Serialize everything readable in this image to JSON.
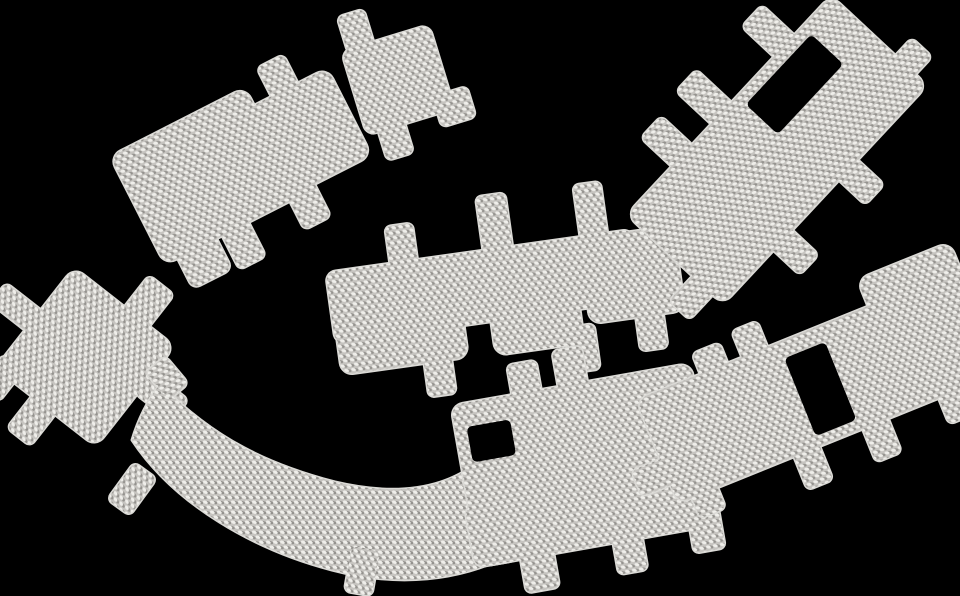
{
  "scene": {
    "description": "Product photograph of eight die-cut metallic heat-shield insulation pieces with a woven basketweave aluminum texture, scattered loosely on a black background. Each piece is an irregular panel with short rounded mounting tabs on its edges; two pieces have rectangular slot cutouts.",
    "canvas": {
      "width": 960,
      "height": 596
    },
    "background": "#000000",
    "piece_count": 8,
    "material": {
      "name": "woven-aluminum-basketweave",
      "base": "#c6c4c0",
      "highlight": "#efeeea",
      "highlight2": "#f6f5f1",
      "shadow": "#94928e",
      "edge": "#dbdad6"
    },
    "pieces": [
      {
        "id": "panel-top-left",
        "transform": "translate(243,158) rotate(-27)",
        "parts": [
          {
            "name": "body-left",
            "rect": [
              -118,
              -62,
              152,
              122,
              12
            ]
          },
          {
            "name": "body-right",
            "rect": [
              8,
              -42,
              108,
              98,
              12
            ]
          },
          {
            "name": "tab-top",
            "rect": [
              53,
              -74,
              30,
              40,
              6
            ]
          },
          {
            "name": "tab-foot",
            "rect": [
              -104,
              48,
              44,
              46,
              8
            ]
          },
          {
            "name": "tab-bottom-1",
            "rect": [
              -54,
              52,
              30,
              46,
              6
            ]
          },
          {
            "name": "tab-bottom-2",
            "rect": [
              22,
              46,
              30,
              46,
              6
            ]
          }
        ],
        "holes": []
      },
      {
        "id": "pad-small-top-left",
        "transform": "translate(398,80) rotate(-17)",
        "parts": [
          {
            "name": "body",
            "rect": [
              -46,
              -44,
              92,
              88,
              10
            ]
          },
          {
            "name": "tab-top",
            "rect": [
              -40,
              -78,
              28,
              38,
              6
            ]
          },
          {
            "name": "tab-corner",
            "rect": [
              28,
              26,
              36,
              32,
              6
            ]
          },
          {
            "name": "tab-bottom",
            "rect": [
              -34,
              38,
              28,
              36,
              6
            ]
          }
        ],
        "holes": []
      },
      {
        "id": "strip-middle",
        "transform": "translate(545,290) rotate(-8)",
        "parts": [
          {
            "name": "band",
            "rect": [
              -215,
              -48,
              310,
              72,
              10
            ]
          },
          {
            "name": "lobe-left",
            "rect": [
              -213,
              -46,
              128,
              102,
              12
            ]
          },
          {
            "name": "lobe-mid",
            "rect": [
              -58,
              -46,
              90,
              104,
              12
            ]
          },
          {
            "name": "lobe-right",
            "rect": [
              40,
              -46,
              96,
              86,
              12
            ]
          },
          {
            "name": "tab-top-1",
            "rect": [
              -150,
              -85,
              28,
              48,
              6
            ]
          },
          {
            "name": "tab-top-2",
            "rect": [
              -56,
              -102,
              30,
              60,
              6
            ]
          },
          {
            "name": "tab-top-3",
            "rect": [
              42,
              -100,
              28,
              56,
              6
            ]
          },
          {
            "name": "tab-hang-left",
            "rect": [
              -130,
              48,
              28,
              42,
              6
            ]
          },
          {
            "name": "tab-hang-mid",
            "rect": [
              16,
              40,
              28,
              46,
              6
            ]
          },
          {
            "name": "tab-end",
            "rect": [
              86,
              28,
              28,
              46,
              6
            ]
          }
        ],
        "holes": []
      },
      {
        "id": "pad-diamond-left",
        "transform": "translate(85,357) rotate(38)",
        "parts": [
          {
            "name": "body",
            "rect": [
              -64,
              -64,
              128,
              128,
              12
            ]
          },
          {
            "name": "tab-top",
            "rect": [
              0,
              -104,
              32,
              46,
              6
            ]
          },
          {
            "name": "tab-right",
            "rect": [
              62,
              -30,
              46,
              28,
              6
            ]
          },
          {
            "name": "tab-left",
            "rect": [
              -108,
              -10,
              48,
              26,
              6
            ]
          },
          {
            "name": "tab-bottom",
            "rect": [
              -18,
              58,
              30,
              46,
              6
            ]
          },
          {
            "name": "tab-corner",
            "rect": [
              -66,
              48,
              26,
              40,
              6
            ]
          }
        ],
        "holes": []
      },
      {
        "id": "swoosh-bottom-left",
        "transform": "",
        "parts": [
          {
            "name": "blade",
            "path": "M160,384 C215,440 270,465 335,482 C390,495 440,492 478,462 L508,556 C460,580 400,588 332,570 C255,550 175,505 132,440 C138,420 148,400 160,384 Z"
          },
          {
            "name": "tab-end",
            "rect": [
              154,
              360,
              26,
              36,
              6
            ],
            "t": "rotate(-40 167 378)"
          },
          {
            "name": "tab-outer",
            "rect": [
              118,
              466,
              28,
              46,
              6
            ],
            "t": "rotate(36 132 489)"
          },
          {
            "name": "tab-bottom",
            "rect": [
              348,
              548,
              28,
              46,
              6
            ],
            "t": "rotate(10 362 571)"
          }
        ],
        "holes": []
      },
      {
        "id": "panel-bottom-center",
        "transform": "translate(585,465) rotate(-10)",
        "parts": [
          {
            "name": "body",
            "rect": [
              -122,
              -82,
              244,
              164,
              12
            ]
          },
          {
            "name": "foot",
            "rect": [
              -126,
              20,
              46,
              62,
              10
            ]
          },
          {
            "name": "tab-top-1",
            "rect": [
              -60,
              -112,
              30,
              42,
              6
            ]
          },
          {
            "name": "tab-top-2",
            "rect": [
              -13,
              -118,
              30,
              48,
              6
            ]
          },
          {
            "name": "tab-bottom-1",
            "rect": [
              14,
              66,
              30,
              48,
              6
            ]
          },
          {
            "name": "tab-bottom-2",
            "rect": [
              92,
              58,
              32,
              48,
              6
            ]
          },
          {
            "name": "tab-bottom-left",
            "rect": [
              -80,
              72,
              34,
              44,
              6
            ]
          }
        ],
        "holes": [
          [
            -110,
            -58,
            44,
            36
          ]
        ]
      },
      {
        "id": "panel-bottom-right",
        "transform": "translate(810,390) rotate(-22)",
        "parts": [
          {
            "name": "body",
            "rect": [
              -165,
              -56,
              330,
              112,
              12
            ]
          },
          {
            "name": "head",
            "rect": [
              85,
              -85,
              100,
              135,
              12
            ]
          },
          {
            "name": "tab-top-1",
            "rect": [
              -96,
              -78,
              30,
              44,
              6
            ]
          },
          {
            "name": "tab-top-2",
            "rect": [
              -51,
              -84,
              28,
              40,
              6
            ]
          },
          {
            "name": "tab-bottom-1",
            "rect": [
              34,
              48,
              28,
              44,
              6
            ]
          },
          {
            "name": "tab-bottom-2",
            "rect": [
              -40,
              50,
              28,
              42,
              6
            ]
          },
          {
            "name": "tab-left-end",
            "rect": [
              -196,
              8,
              44,
              28,
              6
            ]
          },
          {
            "name": "tab-bottom-left",
            "rect": [
              -150,
              36,
              28,
              42,
              6
            ]
          },
          {
            "name": "tab-head-bottom",
            "rect": [
              116,
              40,
              30,
              44,
              6
            ]
          }
        ],
        "holes": [
          [
            -12,
            -39,
            44,
            84
          ]
        ]
      },
      {
        "id": "panel-top-right",
        "transform": "translate(777,150) rotate(-47)",
        "parts": [
          {
            "name": "body",
            "rect": [
              -150,
              -66,
              300,
              132,
              12
            ]
          },
          {
            "name": "tab-top-1",
            "rect": [
              -84,
              -108,
              30,
              46,
              6
            ]
          },
          {
            "name": "tab-top-2",
            "rect": [
              -26,
              -114,
              30,
              52,
              6
            ]
          },
          {
            "name": "tab-top-3",
            "rect": [
              66,
              -110,
              30,
              50,
              6
            ]
          },
          {
            "name": "tab-right",
            "rect": [
              130,
              22,
              44,
              28,
              6
            ]
          },
          {
            "name": "tab-bottom-1",
            "rect": [
              -76,
              58,
              28,
              44,
              6
            ]
          },
          {
            "name": "tab-bottom-2",
            "rect": [
              20,
              56,
              28,
              46,
              6
            ]
          },
          {
            "name": "tab-left-end",
            "rect": [
              -184,
              24,
              44,
              28,
              6
            ]
          }
        ],
        "holes": [
          [
            12,
            -54,
            96,
            44
          ]
        ]
      }
    ]
  }
}
